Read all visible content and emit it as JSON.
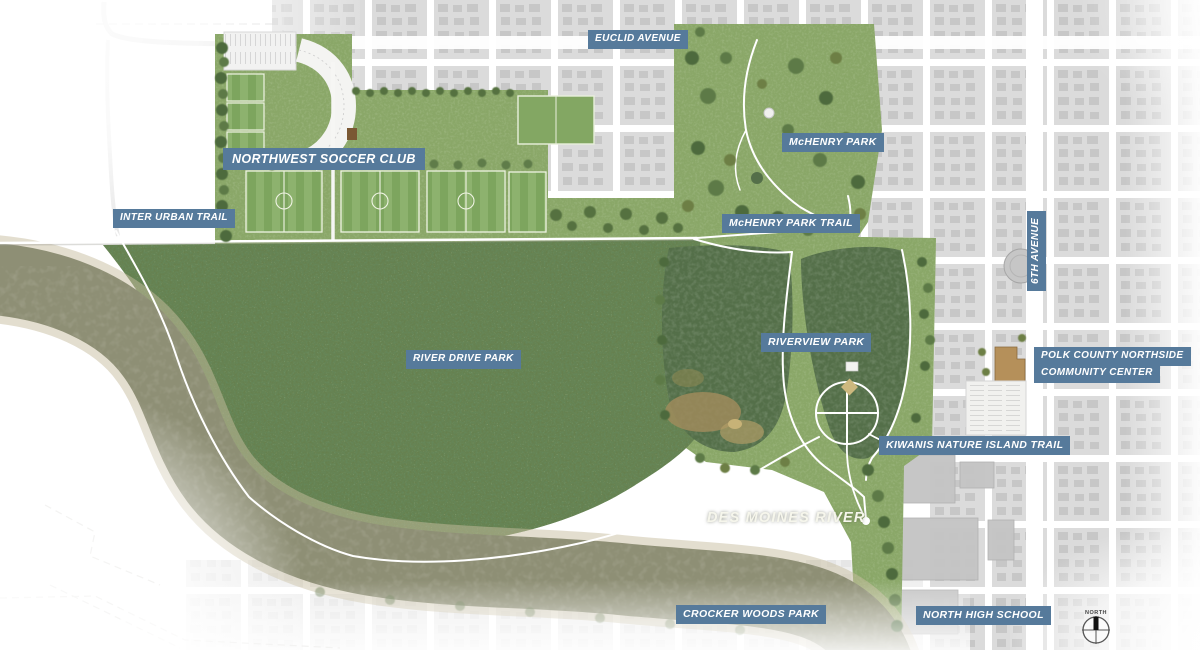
{
  "labels": {
    "euclid_avenue": "EUCLID AVENUE",
    "northwest_soccer_club": "NORTHWEST SOCCER CLUB",
    "mchenry_park": "McHENRY PARK",
    "inter_urban_trail": "INTER URBAN TRAIL",
    "mchenry_park_trail": "McHENRY PARK TRAIL",
    "sixth_avenue": "6TH AVENUE",
    "river_drive_park": "RIVER DRIVE PARK",
    "riverview_park": "RIVERVIEW PARK",
    "polk_county_line1": "POLK COUNTY NORTHSIDE",
    "polk_county_line2": "COMMUNITY CENTER",
    "kiwanis_nature_island_trail": "KIWANIS NATURE ISLAND TRAIL",
    "des_moines_river": "DES MOINES RIVER",
    "crocker_woods_park": "CROCKER WOODS PARK",
    "north_high_school": "NORTH HIGH SCHOOL"
  },
  "compass": {
    "north_label": "NORTH"
  },
  "colors": {
    "label_bg": "#567a9b",
    "label_text": "#ffffff",
    "river_water": "#8e8f75",
    "pond_water": "#546f49",
    "forest_green": "#66804e",
    "lawn_green": "#8aa768",
    "city_block": "#dbdbdb"
  }
}
